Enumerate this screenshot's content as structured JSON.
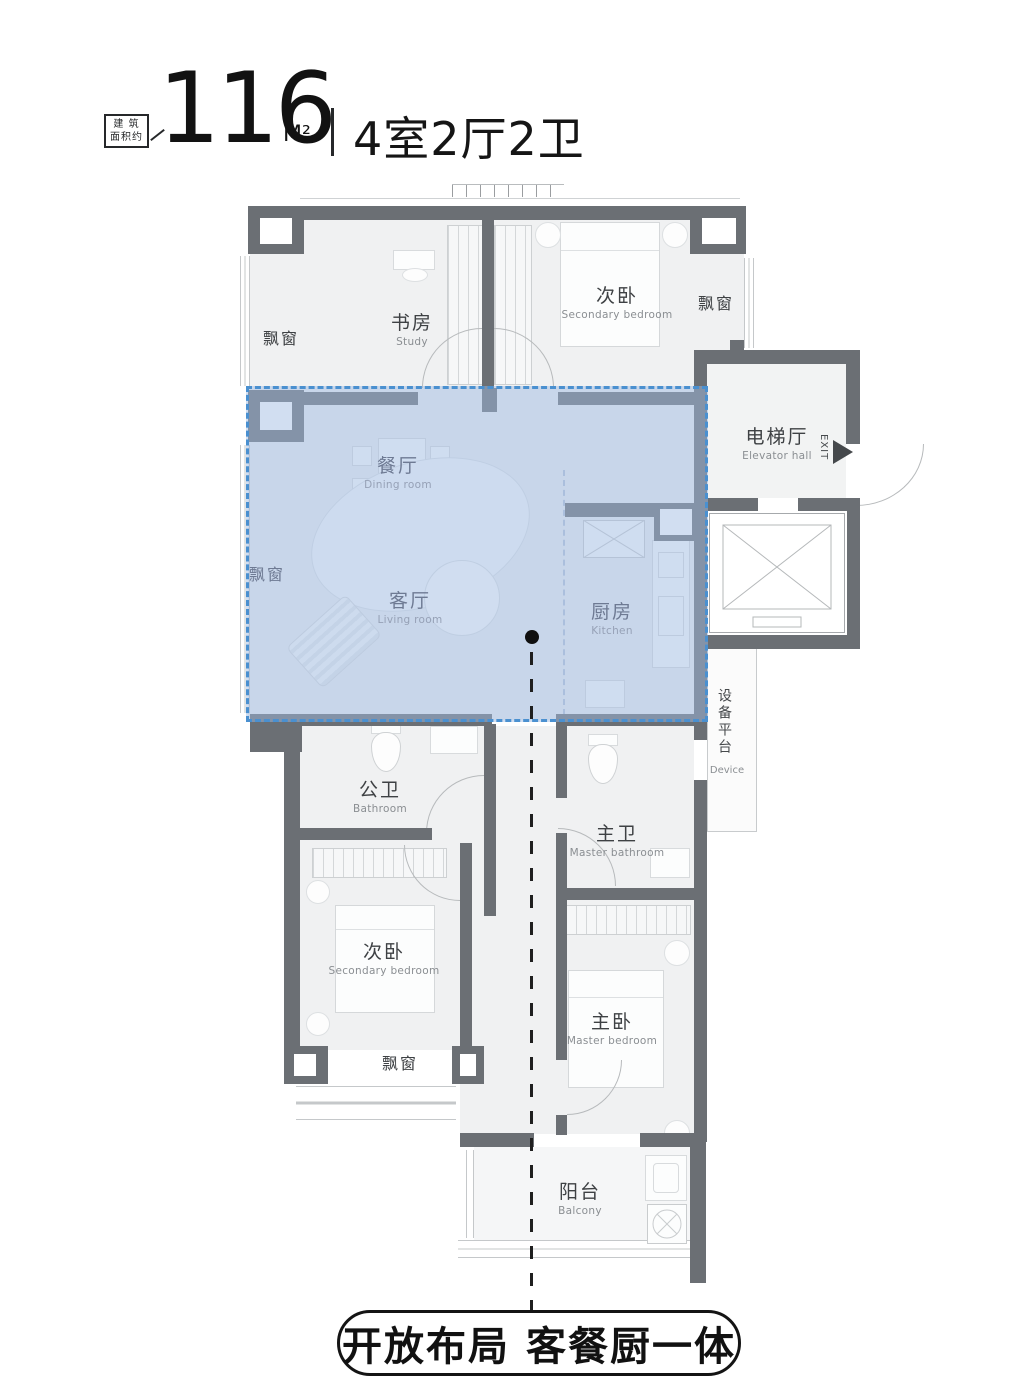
{
  "header": {
    "badge": {
      "line1": "建 筑",
      "line2": "面积约"
    },
    "area_value": "116",
    "area_unit": "M²",
    "layout_text": "4室2厅2卫"
  },
  "rooms": {
    "study": {
      "cn": "书房",
      "en": "Study"
    },
    "secondary_bedroom_top": {
      "cn": "次卧",
      "en": "Secondary bedroom"
    },
    "elevator_hall": {
      "cn": "电梯厅",
      "en": "Elevator hall"
    },
    "dining_room": {
      "cn": "餐厅",
      "en": "Dining room"
    },
    "living_room": {
      "cn": "客厅",
      "en": "Living room"
    },
    "kitchen": {
      "cn": "厨房",
      "en": "Kitchen"
    },
    "device_platform": {
      "cn": "设备平台",
      "en": "Device"
    },
    "bathroom": {
      "cn": "公卫",
      "en": "Bathroom"
    },
    "master_bathroom": {
      "cn": "主卫",
      "en": "Master bathroom"
    },
    "secondary_bedroom_bottom": {
      "cn": "次卧",
      "en": "Secondary bedroom"
    },
    "master_bedroom": {
      "cn": "主卧",
      "en": "Master bedroom"
    },
    "balcony": {
      "cn": "阳台",
      "en": "Balcony"
    }
  },
  "labels": {
    "bay_window": "飘窗",
    "exit": "EXIT"
  },
  "annotation": {
    "slogan": "开放布局 客餐厨一体"
  },
  "colors": {
    "wall": "#6b6f74",
    "highlight_fill": "#9eb9e2",
    "highlight_border": "#4a90d0",
    "floor": "#f0f1f2",
    "text_dark": "#1a1a1a",
    "room_label": "#3e4144",
    "room_label_sub": "#8a8e92"
  }
}
